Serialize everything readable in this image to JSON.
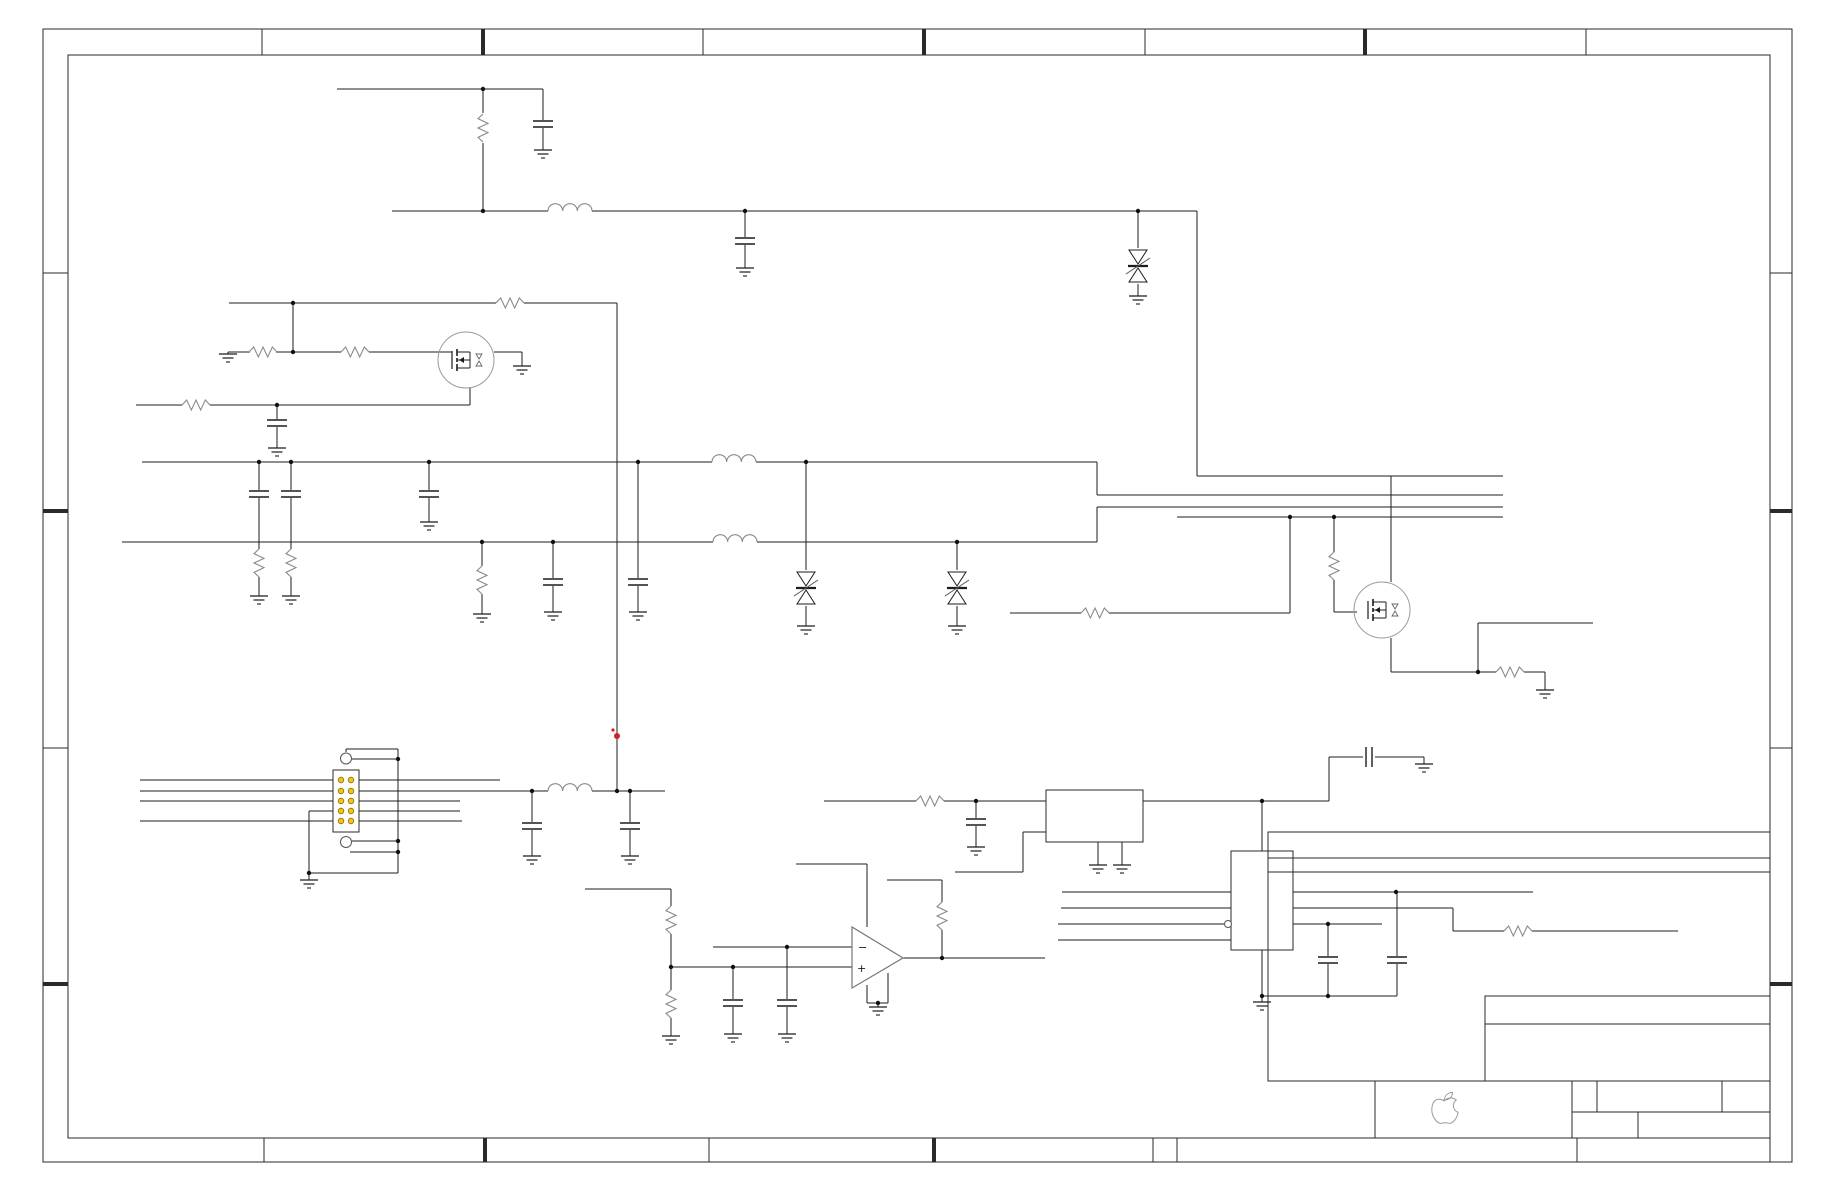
{
  "meta": {
    "width": 1836,
    "height": 1188,
    "bg": "#ffffff",
    "description": "circuit-schematic-no-text"
  },
  "colors": {
    "wire": "#1c1c1c",
    "component": "#1c1c1c",
    "passive": "#8a8a8a",
    "circle": "#9a9a9a",
    "frame": "#2a2a2a",
    "dot": "#111111",
    "red": "#cc2222",
    "pin_fill": "#f0c419",
    "pin_stroke": "#8a6d00",
    "logo": "#9a9a9a",
    "bubble": "#555555"
  },
  "frame": {
    "outer": [
      43,
      29,
      1749,
      1133
    ],
    "inner": [
      68,
      55,
      1702,
      1083
    ],
    "top_ticks": [
      [
        262,
        "thin"
      ],
      [
        483,
        "thick"
      ],
      [
        703,
        "thin"
      ],
      [
        924,
        "thick"
      ],
      [
        1145,
        "thin"
      ],
      [
        1365,
        "thick"
      ],
      [
        1586,
        "thin"
      ]
    ],
    "bottom_ticks": [
      [
        264,
        "thin"
      ],
      [
        485,
        "thick"
      ],
      [
        709,
        "thin"
      ],
      [
        934,
        "thick"
      ],
      [
        1153,
        "thin"
      ]
    ],
    "left_ticks": [
      [
        273,
        "thin"
      ],
      [
        511,
        "thick"
      ],
      [
        748,
        "thin"
      ],
      [
        984,
        "thick"
      ]
    ],
    "right_ticks": [
      [
        273,
        "thin"
      ],
      [
        511,
        "thick"
      ],
      [
        748,
        "thin"
      ],
      [
        984,
        "thick"
      ]
    ]
  },
  "title_block": {
    "logo_box": [
      1375,
      1081,
      197,
      57
    ],
    "cells_box": [
      1572,
      1081,
      198,
      57
    ],
    "cells_mid_y": 1112,
    "cells_top_dividers": [
      1597,
      1722
    ],
    "cells_bottom_divider": 1638,
    "strip": [
      1177,
      1138,
      593,
      24
    ],
    "strip_divider": 1577,
    "revision_box": [
      1268,
      832,
      502,
      249
    ],
    "revision_hlines": [
      858,
      872
    ],
    "sub_box": [
      1485,
      996,
      285,
      85
    ],
    "sub_hline": 1024,
    "apple_logo_leaf": "M 1444,1100 C 1445,1095.5 1448,1092.5 1452.5,1092.5 C 1452.5,1097 1449,1100 1444,1100 Z",
    "apple_logo_body": "M 1444,1101 C 1441,1098.5 1436,1098.5 1433.8,1102 C 1431,1106.5 1431.2,1113.5 1434.2,1118.2 C 1436.2,1121.3 1439.2,1124.2 1442.2,1123.2 C 1444.2,1122.6 1446.2,1122.6 1448.2,1123.2 C 1451.2,1124.2 1454.2,1121.3 1456,1118.2 C 1457.1,1116.2 1457.9,1114.2 1458.1,1112.4 C 1455.1,1111.2 1453.2,1108.4 1453.3,1105.4 C 1453.4,1103.2 1454.5,1101.2 1456.3,1100.1 C 1453.3,1097.1 1447.3,1097.3 1444,1101 Z"
  },
  "opamp": {
    "points": "852,927 852,988 903,958",
    "minus_label": "−",
    "plus_label": "+",
    "minus_pos": [
      858,
      951
    ],
    "plus_pos": [
      857,
      972
    ]
  },
  "schematic": {
    "wires": [
      [
        337,
        89,
        543,
        89
      ],
      [
        483,
        89,
        483,
        113
      ],
      [
        483,
        143,
        483,
        211
      ],
      [
        543,
        89,
        543,
        120
      ],
      [
        543,
        128,
        543,
        150
      ],
      [
        392,
        211,
        548,
        211
      ],
      [
        592,
        211,
        1197,
        211
      ],
      [
        745,
        211,
        745,
        237
      ],
      [
        745,
        245,
        745,
        268
      ],
      [
        1138,
        211,
        1138,
        248
      ],
      [
        1138,
        284,
        1138,
        296
      ],
      [
        1197,
        211,
        1197,
        476
      ],
      [
        1197,
        476,
        1503,
        476
      ],
      [
        229,
        303,
        496,
        303
      ],
      [
        524,
        303,
        617,
        303
      ],
      [
        617,
        303,
        617,
        791
      ],
      [
        228,
        352,
        250,
        352
      ],
      [
        276,
        352,
        341,
        352
      ],
      [
        369,
        352,
        452,
        352
      ],
      [
        228,
        352,
        228,
        354
      ],
      [
        293,
        303,
        293,
        352
      ],
      [
        494,
        352,
        522,
        352
      ],
      [
        522,
        352,
        522,
        366
      ],
      [
        136,
        405,
        182,
        405
      ],
      [
        210,
        405,
        470,
        405
      ],
      [
        470,
        405,
        470,
        388
      ],
      [
        277,
        405,
        277,
        419
      ],
      [
        277,
        427,
        277,
        448
      ],
      [
        142,
        462,
        712,
        462
      ],
      [
        756,
        462,
        1097,
        462
      ],
      [
        1097,
        462,
        1097,
        495
      ],
      [
        1097,
        495,
        1503,
        495
      ],
      [
        122,
        542,
        713,
        542
      ],
      [
        757,
        542,
        1097,
        542
      ],
      [
        1097,
        507,
        1097,
        542
      ],
      [
        1097,
        507,
        1503,
        507
      ],
      [
        1177,
        517,
        1503,
        517
      ],
      [
        259,
        462,
        259,
        490
      ],
      [
        259,
        498,
        259,
        549
      ],
      [
        259,
        577,
        259,
        596
      ],
      [
        291,
        462,
        291,
        490
      ],
      [
        291,
        498,
        291,
        549
      ],
      [
        291,
        577,
        291,
        596
      ],
      [
        429,
        462,
        429,
        490
      ],
      [
        429,
        498,
        429,
        522
      ],
      [
        482,
        542,
        482,
        566
      ],
      [
        482,
        594,
        482,
        614
      ],
      [
        553,
        542,
        553,
        578
      ],
      [
        553,
        586,
        553,
        612
      ],
      [
        638,
        462,
        638,
        578
      ],
      [
        638,
        586,
        638,
        612
      ],
      [
        806,
        462,
        806,
        570
      ],
      [
        806,
        606,
        806,
        626
      ],
      [
        957,
        542,
        957,
        570
      ],
      [
        957,
        606,
        957,
        626
      ],
      [
        1010,
        613,
        1081,
        613
      ],
      [
        1109,
        613,
        1290,
        613
      ],
      [
        1290,
        613,
        1290,
        517
      ],
      [
        1334,
        517,
        1334,
        552
      ],
      [
        1334,
        580,
        1334,
        612
      ],
      [
        1334,
        612,
        1357,
        612
      ],
      [
        1391,
        476,
        1391,
        582
      ],
      [
        1391,
        638,
        1391,
        672
      ],
      [
        1391,
        672,
        1496,
        672
      ],
      [
        1524,
        672,
        1545,
        672
      ],
      [
        1545,
        672,
        1545,
        690
      ],
      [
        1478,
        672,
        1478,
        623
      ],
      [
        1478,
        623,
        1593,
        623
      ],
      [
        140,
        780,
        333,
        780
      ],
      [
        140,
        791,
        333,
        791
      ],
      [
        140,
        801,
        333,
        801
      ],
      [
        140,
        821,
        333,
        821
      ],
      [
        309,
        811,
        333,
        811
      ],
      [
        309,
        811,
        309,
        873
      ],
      [
        359,
        780,
        500,
        780
      ],
      [
        359,
        791,
        532,
        791
      ],
      [
        359,
        801,
        460,
        801
      ],
      [
        359,
        811,
        460,
        811
      ],
      [
        359,
        821,
        462,
        821
      ],
      [
        532,
        791,
        548,
        791
      ],
      [
        592,
        791,
        665,
        791
      ],
      [
        532,
        791,
        532,
        822
      ],
      [
        532,
        830,
        532,
        856
      ],
      [
        630,
        791,
        630,
        822
      ],
      [
        630,
        830,
        630,
        856
      ],
      [
        346,
        752,
        346,
        749
      ],
      [
        346,
        749,
        398,
        749
      ],
      [
        398,
        749,
        398,
        873
      ],
      [
        352,
        759,
        398,
        759
      ],
      [
        398,
        873,
        309,
        873
      ],
      [
        309,
        873,
        309,
        880
      ],
      [
        352,
        841,
        398,
        841
      ],
      [
        350,
        852,
        398,
        852
      ],
      [
        585,
        889,
        671,
        889
      ],
      [
        671,
        889,
        671,
        906
      ],
      [
        671,
        934,
        671,
        967
      ],
      [
        671,
        967,
        852,
        967
      ],
      [
        671,
        967,
        671,
        990
      ],
      [
        671,
        1018,
        671,
        1036
      ],
      [
        713,
        947,
        852,
        947
      ],
      [
        733,
        967,
        733,
        999
      ],
      [
        733,
        1007,
        733,
        1034
      ],
      [
        787,
        947,
        787,
        999
      ],
      [
        787,
        1007,
        787,
        1034
      ],
      [
        867,
        927,
        867,
        864
      ],
      [
        867,
        864,
        796,
        864
      ],
      [
        867,
        985,
        867,
        1003
      ],
      [
        888,
        973,
        888,
        1003
      ],
      [
        867,
        1003,
        888,
        1003
      ],
      [
        878,
        1003,
        878,
        1007
      ],
      [
        903,
        958,
        1045,
        958
      ],
      [
        942,
        958,
        942,
        930
      ],
      [
        942,
        902,
        942,
        880
      ],
      [
        942,
        880,
        887,
        880
      ],
      [
        824,
        801,
        916,
        801
      ],
      [
        944,
        801,
        1046,
        801
      ],
      [
        976,
        801,
        976,
        818
      ],
      [
        976,
        826,
        976,
        847
      ],
      [
        955,
        872,
        1023,
        872
      ],
      [
        1023,
        872,
        1023,
        832
      ],
      [
        1023,
        832,
        1046,
        832
      ],
      [
        1098,
        842,
        1098,
        865
      ],
      [
        1122,
        842,
        1122,
        865
      ],
      [
        1143,
        801,
        1329,
        801
      ],
      [
        1329,
        801,
        1329,
        757
      ],
      [
        1329,
        757,
        1363,
        757
      ],
      [
        1375,
        757,
        1424,
        757
      ],
      [
        1424,
        757,
        1424,
        764
      ],
      [
        1262,
        801,
        1262,
        851
      ],
      [
        1062,
        892,
        1231,
        892
      ],
      [
        1061,
        908,
        1231,
        908
      ],
      [
        1058,
        924,
        1224,
        924
      ],
      [
        1058,
        940,
        1231,
        940
      ],
      [
        1293,
        892,
        1533,
        892
      ],
      [
        1293,
        908,
        1453,
        908
      ],
      [
        1453,
        908,
        1453,
        931
      ],
      [
        1453,
        931,
        1504,
        931
      ],
      [
        1532,
        931,
        1678,
        931
      ],
      [
        1293,
        924,
        1382,
        924
      ],
      [
        1328,
        924,
        1328,
        956
      ],
      [
        1328,
        964,
        1328,
        996
      ],
      [
        1397,
        892,
        1397,
        956
      ],
      [
        1397,
        964,
        1397,
        996
      ],
      [
        1262,
        996,
        1397,
        996
      ],
      [
        1262,
        950,
        1262,
        1002
      ]
    ],
    "junctions": [
      [
        483,
        89
      ],
      [
        483,
        211
      ],
      [
        745,
        211
      ],
      [
        1138,
        211
      ],
      [
        293,
        303
      ],
      [
        293,
        352
      ],
      [
        277,
        405
      ],
      [
        259,
        462
      ],
      [
        291,
        462
      ],
      [
        429,
        462
      ],
      [
        638,
        462
      ],
      [
        806,
        462
      ],
      [
        482,
        542
      ],
      [
        553,
        542
      ],
      [
        957,
        542
      ],
      [
        1290,
        517
      ],
      [
        1334,
        517
      ],
      [
        1478,
        672
      ],
      [
        532,
        791
      ],
      [
        617,
        791
      ],
      [
        630,
        791
      ],
      [
        398,
        759
      ],
      [
        398,
        841
      ],
      [
        398,
        852
      ],
      [
        309,
        873
      ],
      [
        671,
        967
      ],
      [
        733,
        967
      ],
      [
        787,
        947
      ],
      [
        942,
        958
      ],
      [
        878,
        1003
      ],
      [
        976,
        801
      ],
      [
        1262,
        801
      ],
      [
        1396,
        892
      ],
      [
        1328,
        924
      ],
      [
        1262,
        996
      ],
      [
        1328,
        996
      ]
    ],
    "resistors": [
      [
        483,
        128,
        "v"
      ],
      [
        510,
        303,
        "h"
      ],
      [
        263,
        352,
        "h"
      ],
      [
        355,
        352,
        "h"
      ],
      [
        196,
        405,
        "h"
      ],
      [
        259,
        563,
        "v"
      ],
      [
        291,
        563,
        "v"
      ],
      [
        482,
        580,
        "v"
      ],
      [
        1095,
        613,
        "h"
      ],
      [
        1334,
        566,
        "v"
      ],
      [
        1510,
        672,
        "h"
      ],
      [
        671,
        920,
        "v"
      ],
      [
        671,
        1004,
        "v"
      ],
      [
        942,
        916,
        "v"
      ],
      [
        930,
        801,
        "h"
      ],
      [
        1518,
        931,
        "h"
      ]
    ],
    "capacitors": [
      [
        543,
        124,
        "v"
      ],
      [
        745,
        241,
        "v"
      ],
      [
        277,
        423,
        "v"
      ],
      [
        259,
        494,
        "v"
      ],
      [
        291,
        494,
        "v"
      ],
      [
        429,
        494,
        "v"
      ],
      [
        553,
        582,
        "v"
      ],
      [
        638,
        582,
        "v"
      ],
      [
        532,
        826,
        "v"
      ],
      [
        630,
        826,
        "v"
      ],
      [
        733,
        1003,
        "v"
      ],
      [
        787,
        1003,
        "v"
      ],
      [
        976,
        822,
        "v"
      ],
      [
        1369,
        757,
        "h"
      ],
      [
        1328,
        960,
        "v"
      ],
      [
        1397,
        960,
        "v"
      ]
    ],
    "inductors": [
      [
        548,
        592,
        211
      ],
      [
        712,
        756,
        462
      ],
      [
        713,
        757,
        542
      ],
      [
        548,
        592,
        791
      ]
    ],
    "grounds": [
      [
        543,
        150
      ],
      [
        745,
        268
      ],
      [
        1138,
        296
      ],
      [
        228,
        354
      ],
      [
        522,
        366
      ],
      [
        277,
        448
      ],
      [
        259,
        596
      ],
      [
        291,
        596
      ],
      [
        429,
        522
      ],
      [
        482,
        614
      ],
      [
        553,
        612
      ],
      [
        638,
        612
      ],
      [
        806,
        626
      ],
      [
        957,
        626
      ],
      [
        1545,
        690
      ],
      [
        532,
        856
      ],
      [
        630,
        856
      ],
      [
        309,
        880
      ],
      [
        671,
        1036
      ],
      [
        733,
        1034
      ],
      [
        787,
        1034
      ],
      [
        878,
        1007
      ],
      [
        976,
        847
      ],
      [
        1098,
        865
      ],
      [
        1122,
        865
      ],
      [
        1424,
        764
      ],
      [
        1262,
        1002
      ]
    ],
    "zeners": [
      [
        1138,
        266
      ],
      [
        806,
        588
      ],
      [
        957,
        588
      ]
    ],
    "mosfets": [
      [
        466,
        360,
        28
      ],
      [
        1382,
        610,
        28
      ]
    ],
    "boxes": [
      [
        1046,
        790,
        97,
        52,
        "ic-box-1"
      ],
      [
        1231,
        851,
        62,
        99,
        "ic-box-2"
      ]
    ],
    "bubble": [
      1228,
      924
    ],
    "connector": {
      "box": [
        333,
        770,
        26,
        62
      ],
      "pin_cols": [
        341,
        351
      ],
      "pin_rows": [
        780,
        791,
        801,
        811,
        821
      ],
      "pin_r": 2.8,
      "holes": [
        [
          346,
          758.5
        ],
        [
          346,
          842
        ]
      ],
      "hole_r": 5.5
    },
    "red_marks": [
      [
        617,
        736,
        3
      ],
      [
        613,
        730,
        1.6
      ]
    ]
  }
}
